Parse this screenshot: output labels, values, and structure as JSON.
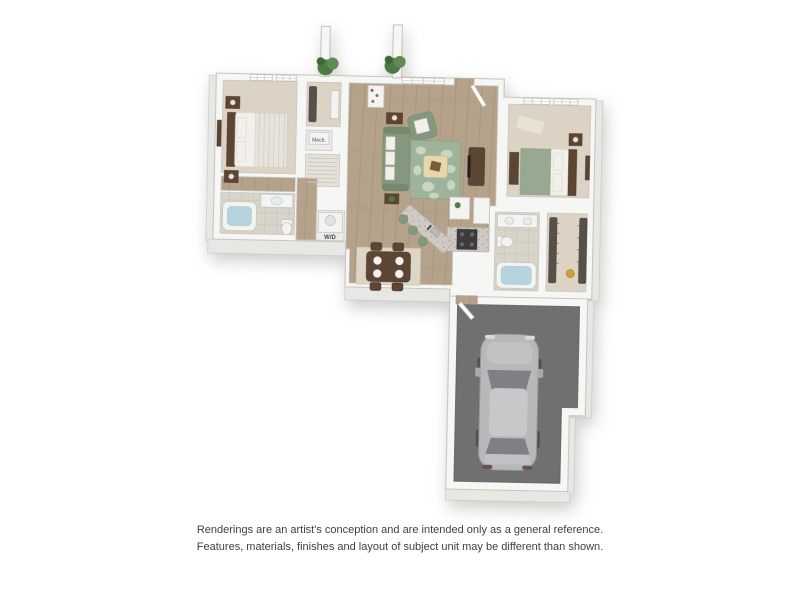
{
  "colors": {
    "wall": "#f6f6f4",
    "wallEdge": "#c7c6c1",
    "wallFace": "#e7e7e3",
    "wood": "#b5a28a",
    "woodLine": "#a18d76",
    "carpet": "#dcd3c4",
    "tile": "#d9d4ca",
    "garageFloor": "#707073",
    "car": "#b6b8ba",
    "carGlass": "#7e8184",
    "carRoof": "#c6c8ca",
    "sofa": "#84987f",
    "rug": "#9eb39c",
    "rugLight": "#d2dbc6",
    "woodDark": "#5c4533",
    "granite": "#cfcbc4",
    "water": "#b7d3dd",
    "plant": "#4d7a45",
    "gold": "#c9a23f",
    "stove": "#3b3b3d",
    "text": "#3f3f3f"
  },
  "floorplan": {
    "labels": {
      "mech": "Mech.",
      "washer_dryer": "W/D"
    }
  },
  "footer": {
    "line1": "Renderings are an artist's conception and are intended only as a general reference.",
    "line2": "Features, materials, finishes and layout of subject unit may be different than shown."
  }
}
